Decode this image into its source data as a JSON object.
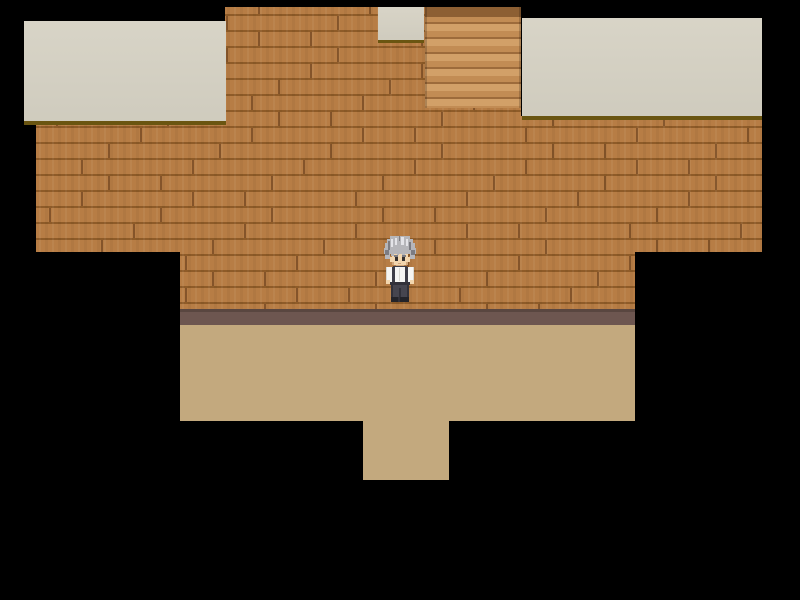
{
  "scene_description": "Top-down RPG game scene: wooden plank building wall with cream roof sections and a staircase tile, tan floor below, elderly villager standing at center",
  "visible_text": "none",
  "palette": {
    "background": "#000000",
    "wall_base": "#b5793f",
    "wall_seam": "#8e5b28",
    "roof_cream": "#d6d2c4",
    "roof_shadow": "#6a5511",
    "stairs_light": "#d2a068",
    "stairs_mid": "#c28c54",
    "stairs_seam": "#9d6b3b",
    "stairs_top": "#8d5f33",
    "ledge": "#6d5650",
    "ledge_edge": "#594640",
    "floor": "#c3a97e"
  },
  "regions": {
    "wall": {
      "x": 0,
      "y": 0,
      "w": 800,
      "h": 600,
      "outline": [
        [
          225,
          7
        ],
        [
          521,
          7
        ],
        [
          521,
          116
        ],
        [
          762,
          116
        ],
        [
          762,
          252
        ],
        [
          635,
          252
        ],
        [
          635,
          309
        ],
        [
          180,
          309
        ],
        [
          180,
          252
        ],
        [
          36,
          252
        ],
        [
          36,
          121
        ],
        [
          225,
          121
        ]
      ]
    },
    "roof_left": {
      "x": 24,
      "y": 21,
      "w": 202,
      "h": 104
    },
    "roof_top": {
      "x": 378,
      "y": 7,
      "w": 46,
      "h": 36
    },
    "roof_right": {
      "x": 522,
      "y": 18,
      "w": 240,
      "h": 102
    },
    "stairs": {
      "x": 425,
      "y": 7,
      "w": 96,
      "h": 101
    },
    "ledge": {
      "x": 180,
      "y": 309,
      "w": 455,
      "h": 16
    },
    "floor": {
      "x": 180,
      "y": 325,
      "w": 455,
      "h": 96
    },
    "floor_tab": {
      "x": 363,
      "y": 421,
      "w": 86,
      "h": 59
    }
  },
  "character": {
    "description": "elderly villager, silver-gray hair, white shirt with dark suspenders, dark gray trousers, facing down",
    "x": 382,
    "y": 236,
    "w": 36,
    "h": 66,
    "colors": {
      "hair_light": "#e4e4e8",
      "hair_mid": "#b6b6ba",
      "hair_dark": "#7c7c82",
      "skin": "#f2d6ae",
      "skin_shadow": "#d2a87c",
      "eyes": "#35302e",
      "shirt": "#f5f5f3",
      "shirt_shadow": "#d8d8d2",
      "suspenders": "#3d3d47",
      "pants": "#46454f",
      "pants_dark": "#32313a",
      "shoes": "#232329"
    }
  }
}
